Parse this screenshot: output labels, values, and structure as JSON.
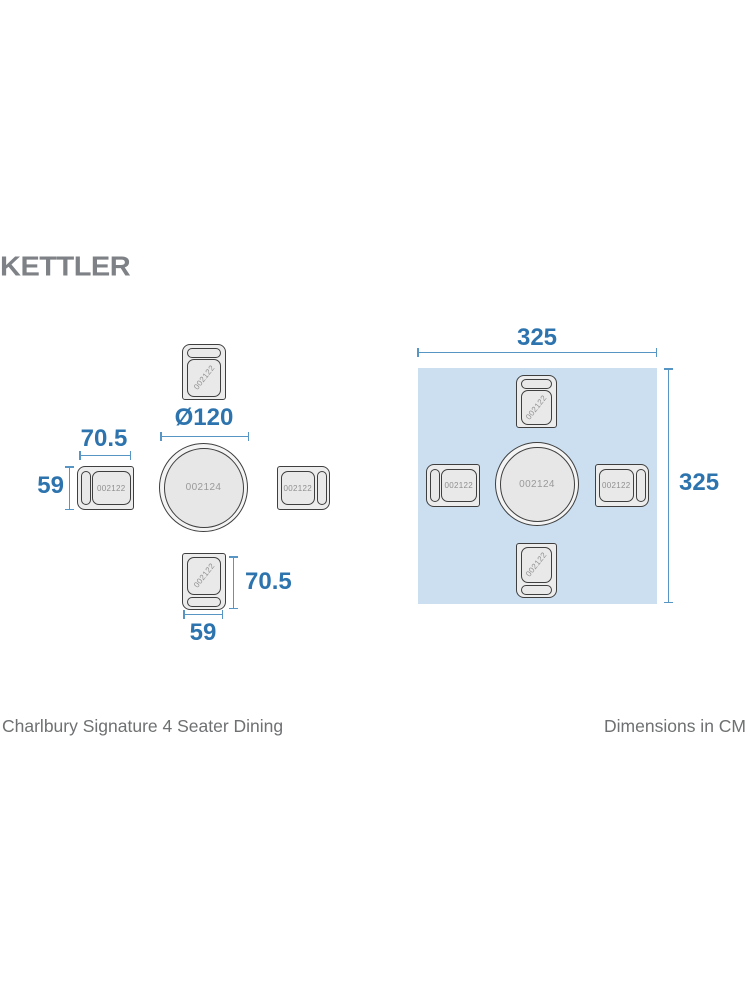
{
  "brand": {
    "logo_text": "KETTLER"
  },
  "codes": {
    "chair": "002122",
    "table": "002124"
  },
  "left_diagram": {
    "table_diameter": "Ø120",
    "side_chair_depth": "70.5",
    "side_chair_width": "59",
    "front_chair_depth": "70.5",
    "front_chair_width": "59"
  },
  "right_diagram": {
    "footprint_width": "325",
    "footprint_height": "325"
  },
  "footer": {
    "product_name": "Charlbury Signature 4 Seater Dining",
    "units_label": "Dimensions in CM"
  },
  "colors": {
    "dimension_text": "#2d74ae",
    "dimension_line": "#5795c4",
    "footprint_fill": "#cbdff0",
    "furniture_outline": "#3f3f3f",
    "furniture_fill": "#ececec",
    "logo_gray": "#7e8185",
    "caption_gray": "#6e7072"
  }
}
